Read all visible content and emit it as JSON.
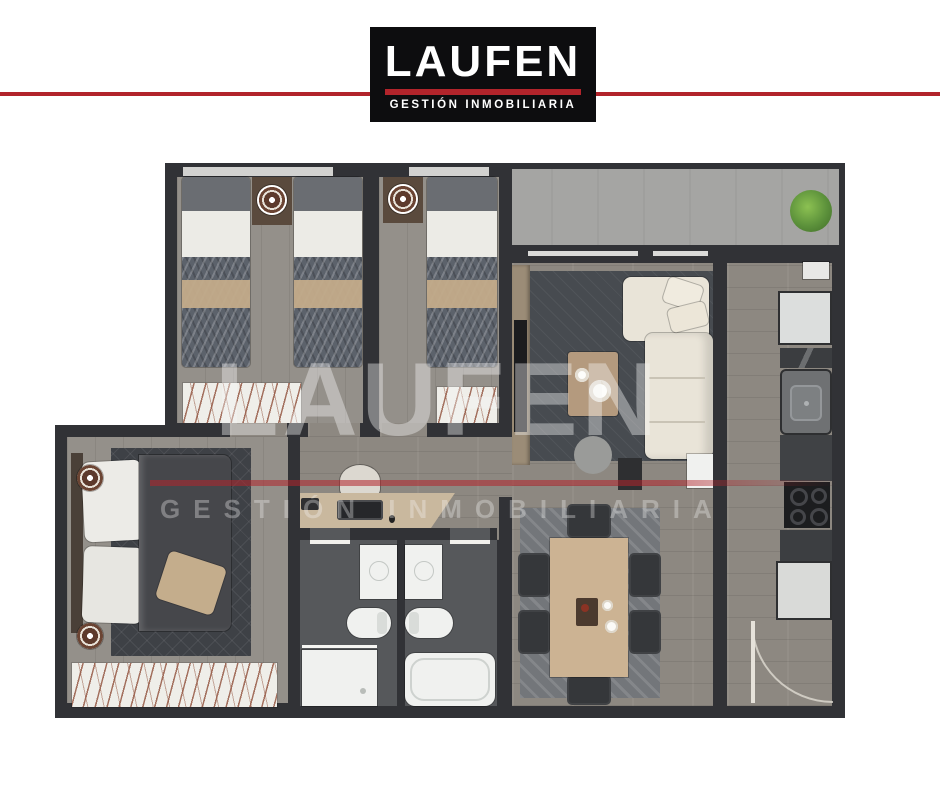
{
  "brand": {
    "name": "LAUFEN",
    "tagline": "GESTIÓN INMOBILIARIA"
  },
  "watermark": {
    "name": "LAUFEN",
    "tagline": "GESTIÓN INMOBILIARIA"
  },
  "colors": {
    "accent_red": "#b2242b",
    "logo_background": "#0d0d0f",
    "wall_dark": "#313236",
    "floor_wood": "#8d8881",
    "floor_concrete": "#a5a5a3",
    "rug_dark": "#3e4146",
    "sofa_cream": "#e9e4d8",
    "wood_light": "#ccb393",
    "fixture_white": "#f0f1ef",
    "plant_green": "#5c913b"
  },
  "floorplan": {
    "type": "apartment-top-view-render",
    "rooms": [
      {
        "name": "bedroom-1",
        "furniture": [
          "twin-bed",
          "twin-bed",
          "nightstand-round-tray",
          "hatched-rug",
          "window"
        ]
      },
      {
        "name": "bedroom-2",
        "furniture": [
          "twin-bed",
          "nightstand-round-tray",
          "hatched-rug",
          "window"
        ]
      },
      {
        "name": "master-bedroom",
        "furniture": [
          "double-bed",
          "area-rug",
          "round-side-table",
          "round-side-table",
          "hatched-rug"
        ]
      },
      {
        "name": "hall-office",
        "furniture": [
          "desk",
          "office-chair",
          "monitor"
        ]
      },
      {
        "name": "bathroom-1",
        "furniture": [
          "vanity-sink",
          "toilet",
          "shower-tray"
        ]
      },
      {
        "name": "bathroom-2",
        "furniture": [
          "vanity-sink",
          "toilet",
          "bathtub"
        ]
      },
      {
        "name": "living-room",
        "furniture": [
          "l-shaped-sofa",
          "throw-pillows",
          "coffee-table",
          "round-pouf",
          "tv-console",
          "side-table"
        ]
      },
      {
        "name": "dining-room",
        "furniture": [
          "dining-table",
          "six-chairs",
          "patterned-rug"
        ]
      },
      {
        "name": "kitchen",
        "furniture": [
          "upper-cabinet",
          "fridge",
          "sink",
          "stove",
          "counters",
          "entry-door"
        ]
      },
      {
        "name": "balcony",
        "furniture": [
          "potted-plant",
          "sliding-glass-door"
        ]
      }
    ]
  }
}
